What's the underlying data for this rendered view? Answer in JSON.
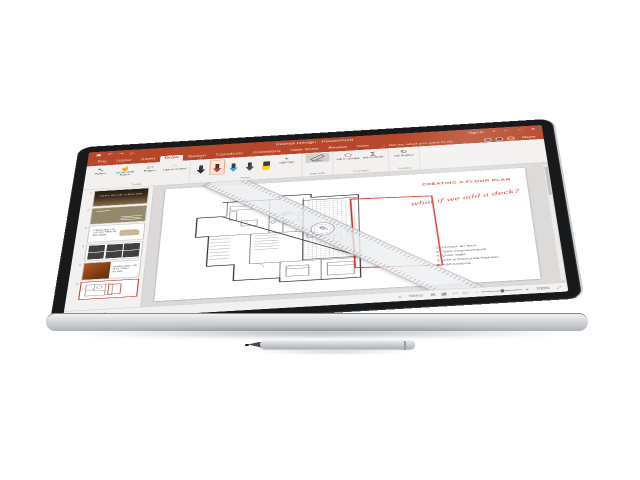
{
  "colors": {
    "accent": "#B7472A",
    "ink_red": "#E02A1E",
    "ruler_gray": "#EAECEF",
    "bezel": "#17191b"
  },
  "window": {
    "title": "Interior Design - PowerPoint",
    "signin": "Sign in",
    "qat": {
      "save": "▣",
      "undo": "↶",
      "redo": "↷",
      "start": "▷"
    },
    "controls": {
      "ribbon_options": "˄",
      "minimize": "—",
      "maximize": "□",
      "close": "✕"
    }
  },
  "tabs": {
    "file": "File",
    "home": "Home",
    "insert": "Insert",
    "draw": "Draw",
    "design": "Design",
    "transitions": "Transitions",
    "animations": "Animations",
    "slideshow": "Slide Show",
    "review": "Review",
    "view": "View",
    "tellme": "Tell me what you want to do",
    "tellme_icon": "☼",
    "share": "Share"
  },
  "ribbon": {
    "groups": {
      "tools": "Tools",
      "pens": "Pens",
      "stencils": "Stencils",
      "convert": "Convert",
      "replay": "Replay"
    },
    "buttons": {
      "select": {
        "label": "Select",
        "icon": "↖"
      },
      "draw_touch": {
        "label": "Draw with Touch",
        "icon": "☝"
      },
      "eraser": {
        "label": "Eraser",
        "icon": "▱"
      },
      "lasso": {
        "label": "Lasso Select",
        "icon": "◌"
      },
      "add_pen": {
        "label": "Add Pen",
        "icon": "+"
      },
      "ruler": {
        "label": "Ruler"
      },
      "ink_to_shape": {
        "label": "Ink to Shape",
        "icon": "⬠"
      },
      "ink_to_math": {
        "label": "Ink to Math",
        "icon": "∑"
      },
      "ink_replay": {
        "label": "Ink Replay",
        "icon": "↻"
      }
    },
    "pens": [
      {
        "name": "black-pen",
        "color": "#2b2b2b",
        "selected": false
      },
      {
        "name": "red-pen",
        "color": "#D13438",
        "selected": true
      },
      {
        "name": "cyan-pen",
        "color": "#31A8C9",
        "selected": false
      },
      {
        "name": "blue-pen",
        "color": "#39506B",
        "selected": false
      },
      {
        "name": "yellow-highlighter",
        "color": "#FFD100",
        "selected": false
      }
    ]
  },
  "thumbnails": [
    {
      "number": "1",
      "title": "INTERIOR DESIGN"
    },
    {
      "number": "2",
      "title": ""
    },
    {
      "number": "3",
      "title": "PRINCIPLES OF INTERIOR DESIGN"
    },
    {
      "number": "4",
      "title": ""
    },
    {
      "number": "5",
      "title": "ANATOMY OF A FLOOR PLAN"
    },
    {
      "number": "6",
      "title": ""
    }
  ],
  "slide": {
    "title": "CREATING A FLOOR PLAN",
    "ink_note": "what if we add a deck?",
    "ruler_angle": "45°",
    "steps": [
      "1. Choose an area",
      "2. Take measurements",
      "3. Draw walls",
      "4. Add architectural features",
      "5. Add furniture"
    ]
  },
  "status": {
    "slide_label": "Slide 6 of 6",
    "display_icon": "⊡",
    "notes_icon": "≡",
    "notes": "Notes",
    "views": {
      "normal": "⊞",
      "sorter": "▦",
      "reading": "▭",
      "slideshow": "▷"
    },
    "zoom_out": "−",
    "zoom_in": "+",
    "zoom_value": "100%",
    "fit": "⤢"
  }
}
